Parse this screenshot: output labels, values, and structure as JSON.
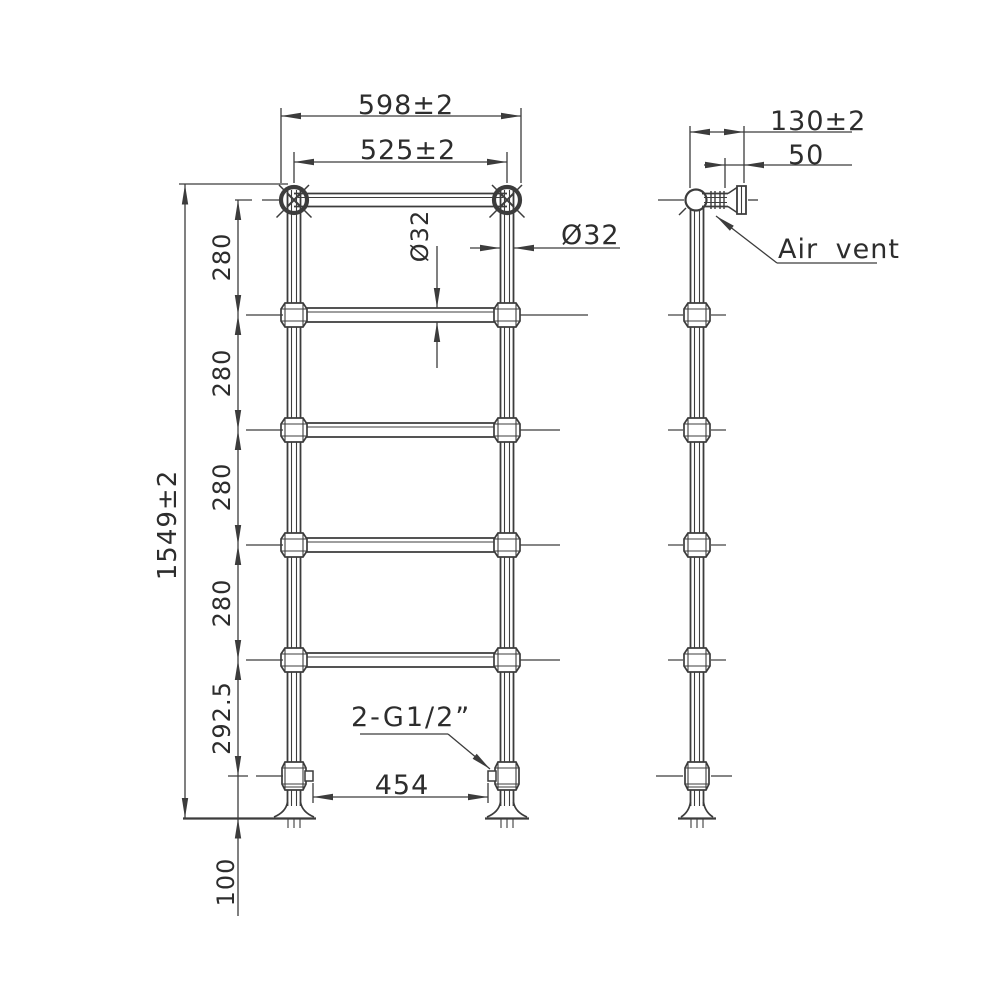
{
  "front_view": {
    "overall_width": "598±2",
    "tube_centres_width": "525±2",
    "overall_height": "1549±2",
    "rung_gaps": [
      "280",
      "280",
      "280",
      "280"
    ],
    "lower_gap": "292.5",
    "floor_clearance": "100",
    "rung_diameter": "Ø32",
    "leg_diameter": "Ø32",
    "connections_width": "454",
    "connections_label": "2-G1/2”"
  },
  "side_view": {
    "depth": "130±2",
    "bracket_offset": "50",
    "air_vent_label": "Air vent"
  },
  "style": {
    "line_color": "#3c3c3c",
    "text_color": "#2d2d2d",
    "background": "#ffffff"
  }
}
